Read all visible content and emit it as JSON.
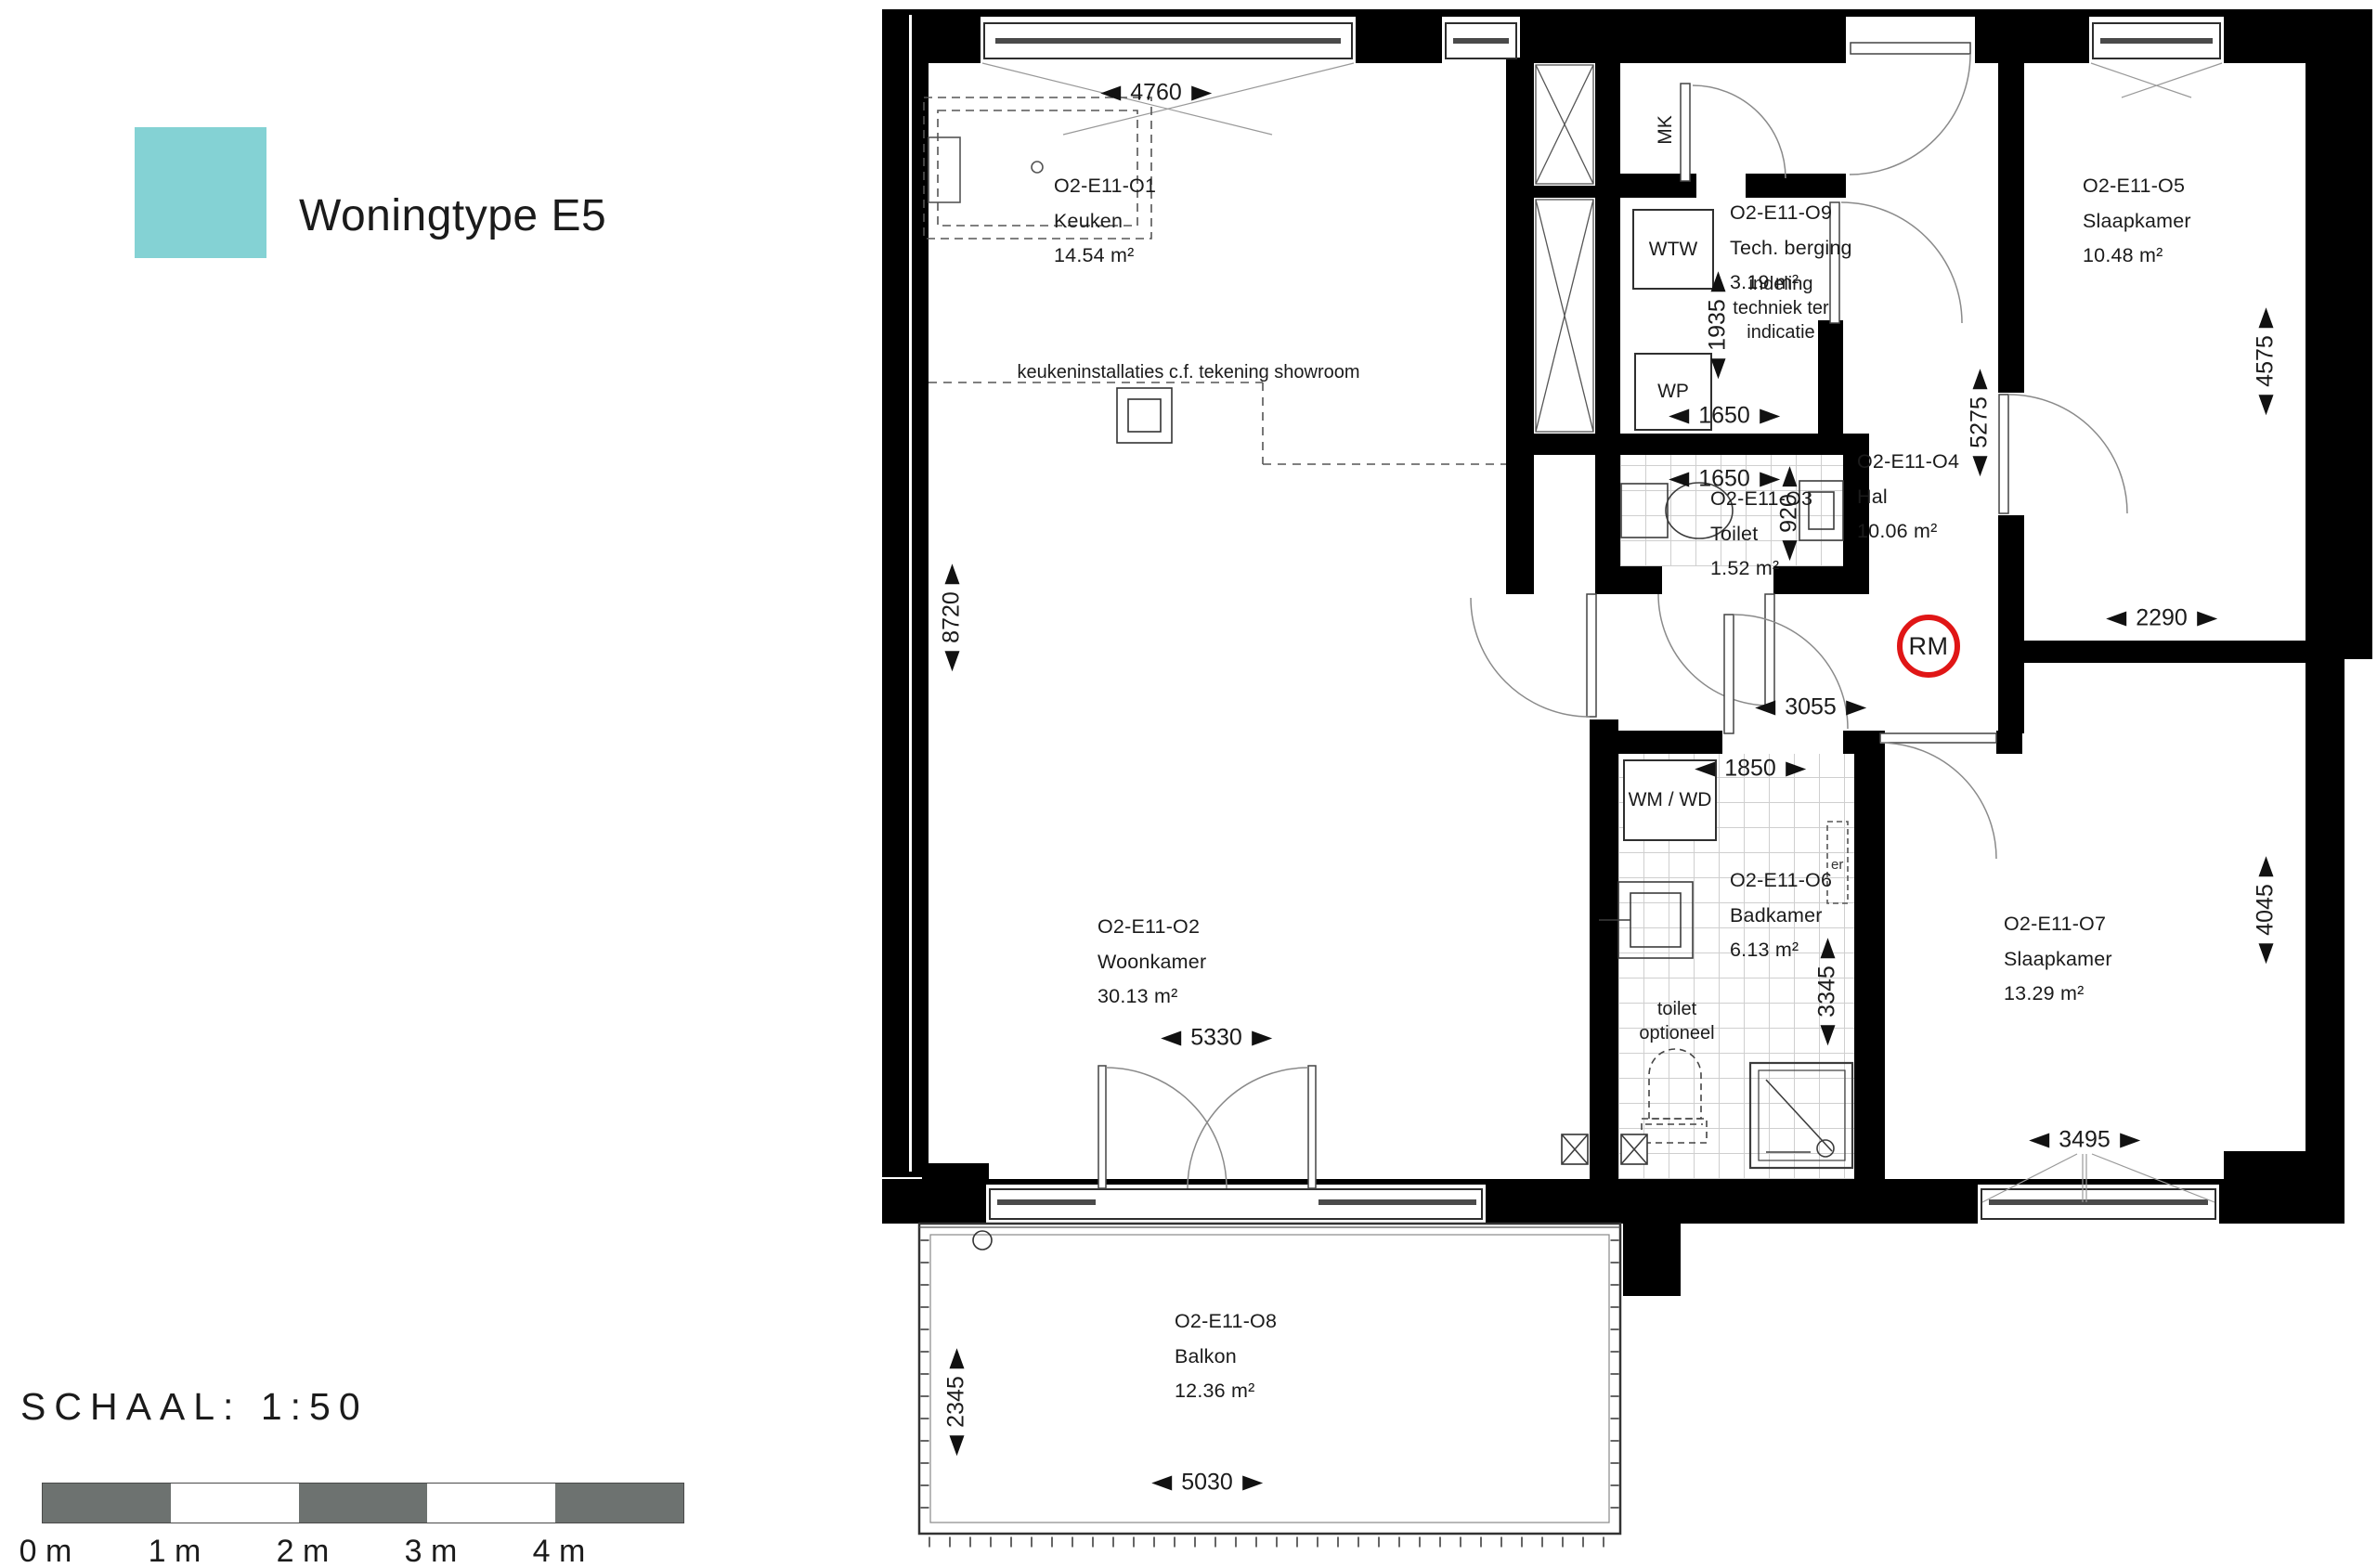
{
  "legend": {
    "title": "Woningtype E5",
    "swatch_color": "#84d2d4"
  },
  "scalebar": {
    "title": "SCHAAL: 1:50",
    "labels": [
      "0 m",
      "1 m",
      "2 m",
      "3 m",
      "4 m"
    ],
    "bar_color": "#6d7270"
  },
  "rooms": {
    "keuken": {
      "code": "O2-E11-O1",
      "name": "Keuken",
      "area": "14.54 m²"
    },
    "woonkamer": {
      "code": "O2-E11-O2",
      "name": "Woonkamer",
      "area": "30.13 m²"
    },
    "toilet": {
      "code": "O2-E11-O3",
      "name": "Toilet",
      "area": "1.52 m²"
    },
    "hal": {
      "code": "O2-E11-O4",
      "name": "Hal",
      "area": "10.06 m²"
    },
    "slaapkamer1": {
      "code": "O2-E11-O5",
      "name": "Slaapkamer",
      "area": "10.48 m²"
    },
    "badkamer": {
      "code": "O2-E11-O6",
      "name": "Badkamer",
      "area": "6.13 m²"
    },
    "slaapkamer2": {
      "code": "O2-E11-O7",
      "name": "Slaapkamer",
      "area": "13.29 m²"
    },
    "balkon": {
      "code": "O2-E11-O8",
      "name": "Balkon",
      "area": "12.36 m²"
    },
    "tech": {
      "code": "O2-E11-O9",
      "name": "Tech. berging",
      "area": "3.19 m²"
    }
  },
  "notes": {
    "kitchen": "keukeninstallaties c.f. tekening showroom",
    "tech_line1": "indeling",
    "tech_line2": "techniek ter",
    "tech_line3": "indicatie",
    "toilet_line1": "toilet",
    "toilet_line2": "optioneel"
  },
  "labels": {
    "mk": "MK",
    "wtw": "WTW",
    "wp": "WP",
    "wmwd": "WM / WD",
    "rm": "RM",
    "er": "er"
  },
  "dimensions": {
    "keuken_width": "4760",
    "left_height": "8720",
    "tech_height": "1935",
    "tech_width": "1650",
    "toilet_width": "1650",
    "toilet_depth": "920",
    "hal_height": "5275",
    "slaapkamer1_height": "4575",
    "slaapkamer1_width": "2290",
    "hal_width": "3055",
    "badkamer_width": "1850",
    "badkamer_height": "3345",
    "slaapkamer2_height": "4045",
    "slaapkamer2_width": "3495",
    "woonkamer_width": "5330",
    "balkon_depth": "2345",
    "balkon_width": "5030"
  },
  "colors": {
    "wall": "#000000",
    "rm_ring": "#e01616",
    "swatch": "#84d2d4",
    "scalebar": "#6d7270"
  }
}
